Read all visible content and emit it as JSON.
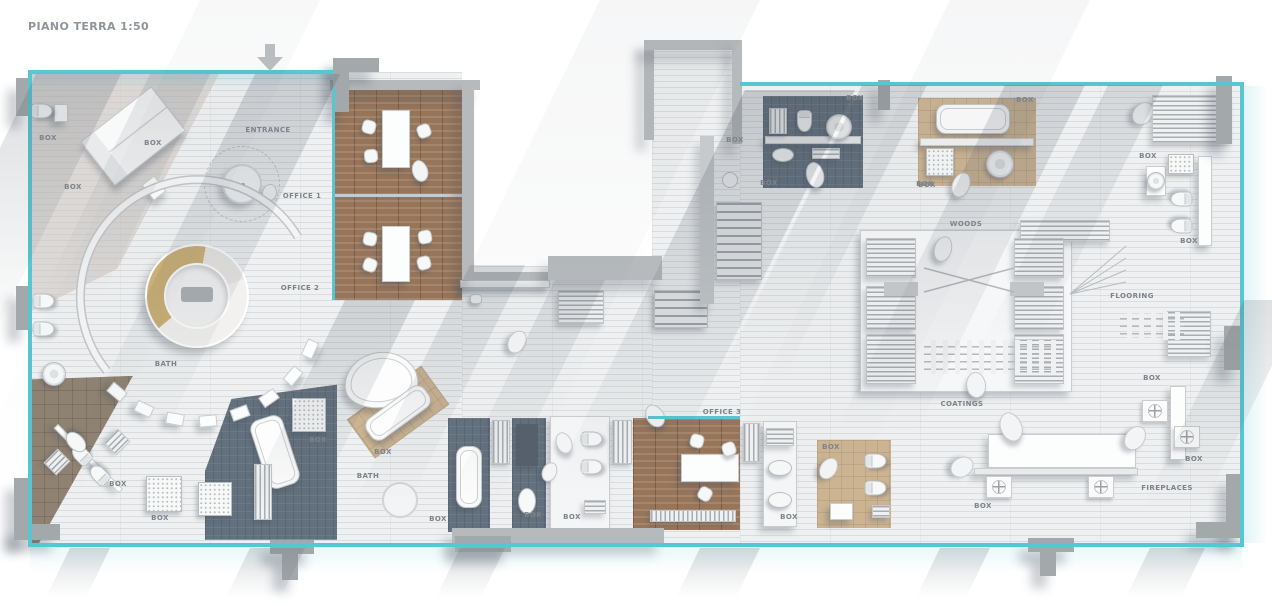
{
  "title": "PIANO TERRA 1:50",
  "colors": {
    "glass": "#57c6d1",
    "wall": "#b6babc",
    "floor": "#eef0f1",
    "wood": "#96755b",
    "slate": "#63707d",
    "tan_tile": "#ccb493",
    "accent_ring": "#cdb176"
  },
  "icons": {
    "entrance_marker": "arrow-down-icon"
  },
  "plan": {
    "labels": [
      {
        "text": "ENTRANCE",
        "x": 268,
        "y": 130
      },
      {
        "text": "OFFICE 1",
        "x": 302,
        "y": 196
      },
      {
        "text": "OFFICE 2",
        "x": 300,
        "y": 288
      },
      {
        "text": "OFFICE 3",
        "x": 722,
        "y": 412
      },
      {
        "text": "BATH",
        "x": 166,
        "y": 364
      },
      {
        "text": "BATH",
        "x": 368,
        "y": 476
      },
      {
        "text": "WOODS",
        "x": 966,
        "y": 224
      },
      {
        "text": "FLOORING",
        "x": 1132,
        "y": 296
      },
      {
        "text": "COATINGS",
        "x": 962,
        "y": 404
      },
      {
        "text": "FIREPLACES",
        "x": 1167,
        "y": 488
      }
    ],
    "box_label_text": "BOX",
    "box_labels": [
      [
        48,
        138
      ],
      [
        153,
        143
      ],
      [
        73,
        187
      ],
      [
        118,
        484
      ],
      [
        160,
        518
      ],
      [
        318,
        440
      ],
      [
        383,
        452
      ],
      [
        438,
        519
      ],
      [
        533,
        515
      ],
      [
        572,
        517
      ],
      [
        735,
        140
      ],
      [
        769,
        183
      ],
      [
        855,
        98
      ],
      [
        927,
        185
      ],
      [
        1025,
        100
      ],
      [
        925,
        184
      ],
      [
        1148,
        156
      ],
      [
        1189,
        241
      ],
      [
        831,
        447
      ],
      [
        789,
        517
      ],
      [
        983,
        506
      ],
      [
        1152,
        378
      ],
      [
        1194,
        459
      ]
    ]
  }
}
